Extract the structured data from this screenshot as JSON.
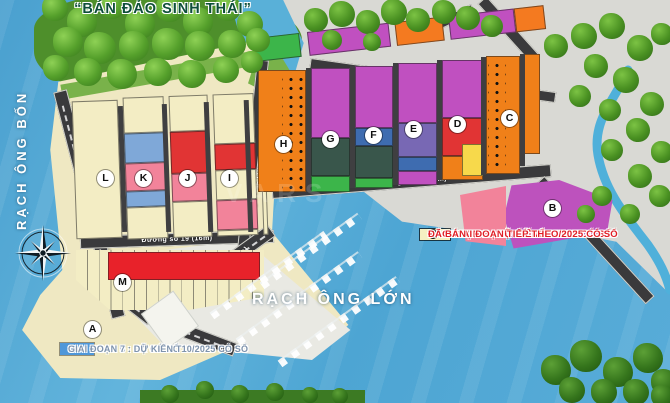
{
  "title": "“BÁN ĐẢO SINH THÁI”",
  "water_labels": {
    "left": "RẠCH ÔNG BỐN",
    "main": "RẠCH ÔNG LỚN"
  },
  "road_labels": {
    "d19b": "Đường số 19B (16m)",
    "d22": "Đường số 22 (13m)",
    "d19": "Đường số 19 (16m)",
    "d9": "Đường số 9 (8m)",
    "lvl": "1983 LVL (12m)",
    "lg": "(mở rộng LG 20.5m)"
  },
  "blocks": {
    "a": "A",
    "b": "B",
    "c": "C",
    "d": "D",
    "e": "E",
    "f": "F",
    "g": "G",
    "h": "H",
    "i": "I",
    "j": "J",
    "k": "K",
    "l": "L",
    "m": "M"
  },
  "legend_right": [
    {
      "color": "#3cb54a",
      "label": "GIAI ĐOẠN 1 : ĐÃ CÓ SỔ"
    },
    {
      "color": "#f9a51a",
      "label": "GIAI ĐOẠN 2 : ĐÃ CÓ SỔ"
    },
    {
      "color": "#c050c0",
      "label": "GIAI ĐOẠN 3 : ĐÃ CÓ SỔ"
    },
    {
      "color": "#3e4a4e",
      "label": "GIAI ĐOẠN 4 : ĐÃ CÓ SỔ"
    },
    {
      "color": "#4a4a9d",
      "label": "GIAI ĐOẠN 8 : DỰ KIẾN T6/2025 CÓ SỔ"
    },
    {
      "color": "#f47a20",
      "label": "GIAI ĐOẠN 9 : DỰ KIẾN T12/2025 CÓ SỔ"
    },
    {
      "color": "#f5f0c2",
      "label": "CÁC GIAI ĐOẠN TIẾP THEO"
    },
    {
      "dot": true,
      "label": "ĐÃ BÁN"
    }
  ],
  "legend_left": [
    {
      "color": "#f2839a",
      "label": "GIAI ĐOẠN 5 : ĐÃ CÓ SỔ"
    },
    {
      "color": "#e8222a",
      "label": "GIAI ĐOẠN 6 : ĐÃ CÓ SỔ"
    },
    {
      "color": "#4f97d9",
      "label": "GIAI ĐOẠN 7 : DỰ KIẾN T10/2025 CÓ SỔ"
    }
  ],
  "watermark": "VARS",
  "map_colors": {
    "phase1_green": "#3cb54a",
    "phase2_amber": "#f9a51a",
    "phase3_magenta": "#c050c0",
    "phase4_dark": "#3e4a4e",
    "phase5_pink": "#f2839a",
    "phase6_red": "#e8222a",
    "phase7_blue": "#4f97d9",
    "phase8_indigo": "#4a4a9d",
    "phase9_orange": "#f47a20",
    "next_cream": "#f5f0c2",
    "sold_dot": "#0c0c0c"
  }
}
